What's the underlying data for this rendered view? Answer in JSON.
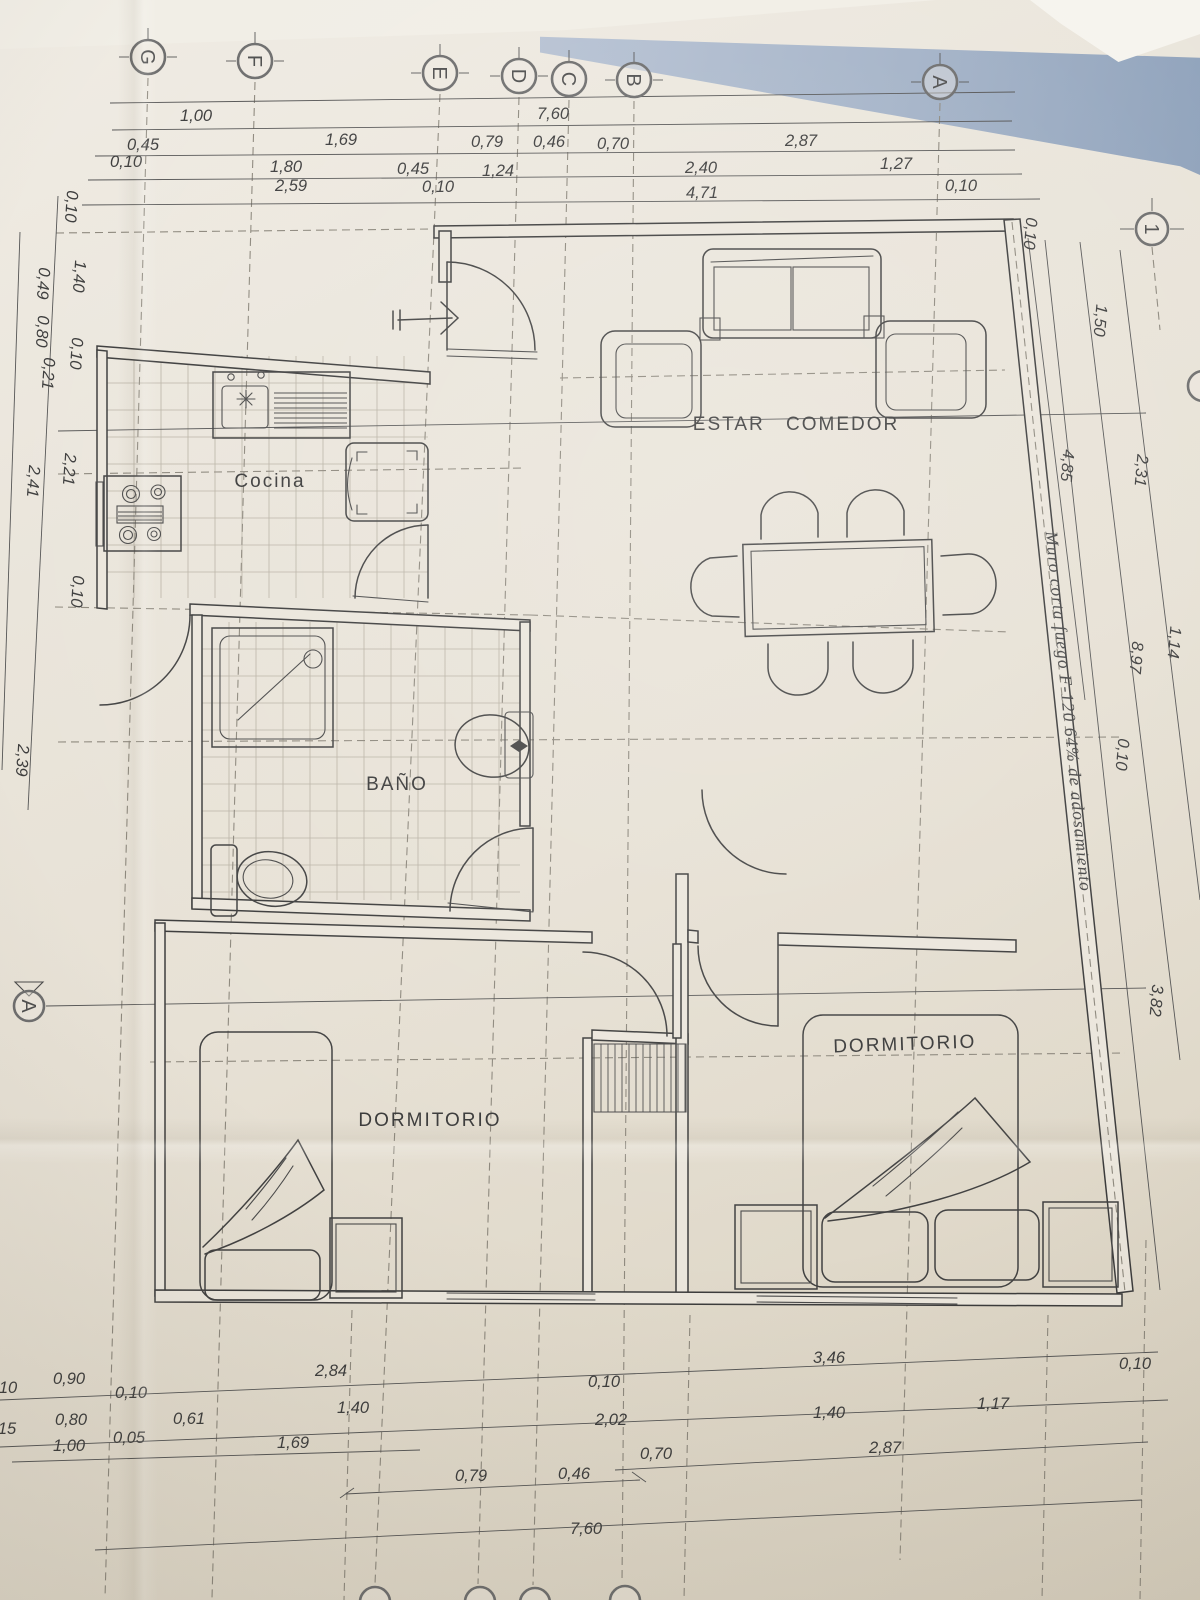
{
  "plan": {
    "grid_letters": [
      "G",
      "F",
      "E",
      "D",
      "C",
      "B",
      "A"
    ],
    "grid_axis_number": "1",
    "section_label": "A",
    "rooms": {
      "kitchen": "Cocina",
      "living_dining": "ESTAR COMEDOR",
      "bathroom": "BAÑO",
      "bedroom_left": "DORMITORIO",
      "bedroom_right": "DORMITORIO"
    },
    "firewall_note": "Muro corta fuego F-120 64% de adosamiento",
    "dims": {
      "top1": [
        "1,00",
        "7,60"
      ],
      "top2": [
        "0,45",
        "1,69",
        "0,79",
        "0,46",
        "0,70",
        "2,87"
      ],
      "top3": [
        "0,10",
        "1,80",
        "0,45",
        "1,24",
        "2,40",
        "1,27"
      ],
      "top4": [
        "2,59",
        "0,10",
        "4,71",
        "0,10"
      ],
      "right": [
        "0,10",
        "1,50",
        "2,31",
        "4,85",
        "8,97",
        "1,14",
        "0,10",
        "3,82"
      ],
      "left": [
        "0,10",
        "1,40",
        "0,49",
        "0,80",
        "0,21",
        "0,10",
        "2,21",
        "2,41",
        "0,10",
        "2,39"
      ],
      "bottom1": [
        "10",
        "0,90",
        "0,10",
        "2,84",
        "0,10",
        "3,46",
        "0,10"
      ],
      "bottom2": [
        "15",
        "0,80",
        "0,05",
        "0,61",
        "1,40",
        "2,02",
        "1,40",
        "1,17"
      ],
      "bottom3": [
        "1,00",
        "1,69",
        "0,79",
        "0,46",
        "0,70",
        "2,87"
      ],
      "bottom4": [
        "7,60"
      ]
    }
  }
}
